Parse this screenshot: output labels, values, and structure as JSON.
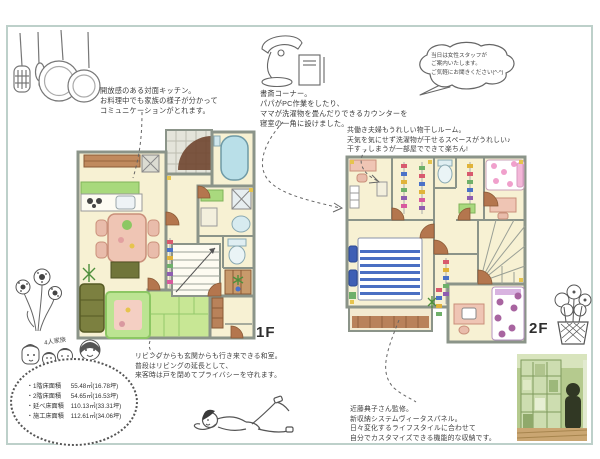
{
  "notes": {
    "kitchen": "開放感のある対面キッチン。\nお料理中でも家族の様子が分かって\nコミュニケーションがとれます。",
    "study": "書斎コーナー。\nパパがPC作業をしたり、\nママが洗濯物を畳んだりできるカウンターを\n寝室の一角に設けました。",
    "staff_bubble": "当日は女性スタッフが\nご案内いたします。\nご気軽にお聞きください(^-^)",
    "laundry": "共働き夫婦もうれしい物干しルーム。\n天気を気にせず洗濯物が干せるスペースがうれしい♪\n干す→しまうが一部屋でできて楽ちん!",
    "washitsu": "リビングからも玄関からも行き来できる和室。\n普段はリビングの延長として、\n来客時は戸を閉めてプライバシーを守れます。",
    "storage": "近藤典子さん監修。\n新収納システムヴィータスパネル。\n日々変化するライフスタイルに合わせて\n自分でカスタマイズできる機能的な収納です。"
  },
  "floor_labels": {
    "first": "1F",
    "second": "2F"
  },
  "family_label": "4人家族",
  "area_table": {
    "rows": [
      {
        "label": "・1階床面積",
        "value": "55.48㎡(16.78坪)"
      },
      {
        "label": "・2階床面積",
        "value": "54.65㎡(16.53坪)"
      },
      {
        "label": "・延べ床面積",
        "value": "110.13㎡(33.31坪)"
      },
      {
        "label": "・施工床面積",
        "value": "112.61㎡(34.06坪)"
      }
    ]
  },
  "colors": {
    "frame": "#bdd0ca",
    "wall": "#8b9489",
    "floor_cream": "#f7f1d3",
    "tatami_green": "#c8e795",
    "counter_green": "#a8d97c",
    "door_brown": "#b4764e",
    "bath_blue": "#b9dfe8",
    "bed_stripe_blue": "#4a6fc3",
    "polka_pink": "#f0a0cc",
    "polka_purple": "#a864a0",
    "sofa_olive": "#7c8040",
    "table_pink": "#efc5b4"
  }
}
